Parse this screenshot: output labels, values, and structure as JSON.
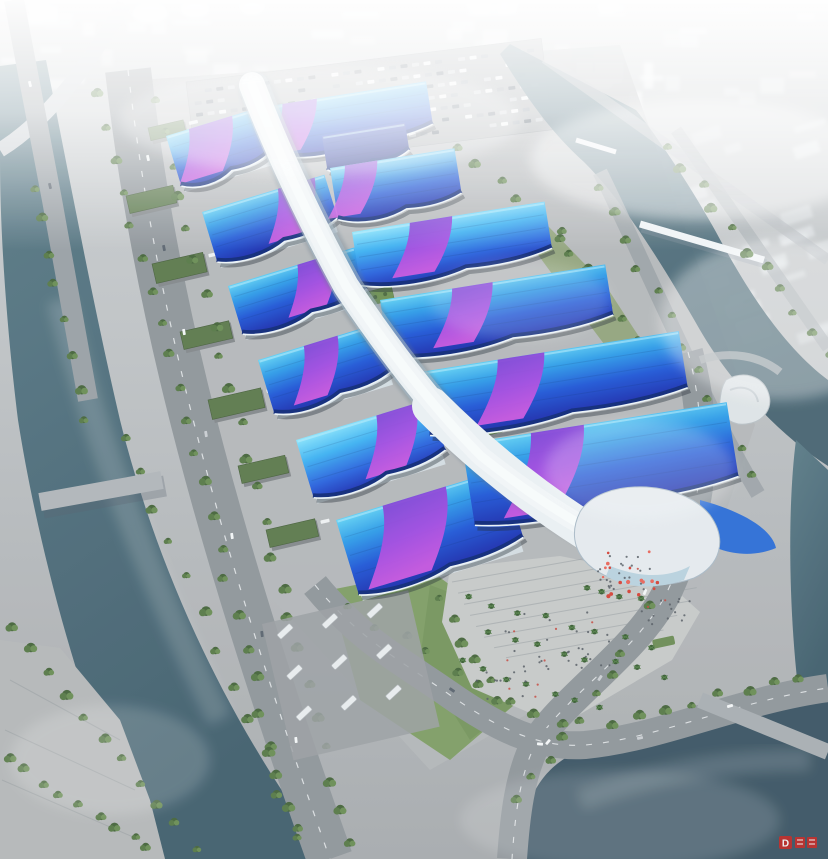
{
  "meta": {
    "aria_label": "Aerial architectural rendering of a large exhibition and convention center campus with blue and purple wave roofs, a white central concourse spine, flanked by rivers, roads and parkland under haze"
  },
  "watermark": {
    "glyph": "D",
    "color": "#c5302c"
  },
  "palette": {
    "ground_top": "#ced2d4",
    "ground_bottom": "#a7abae",
    "concrete": "#b8bbbd",
    "apron": "#b3b6b8",
    "asphalt": "#8f969b",
    "road_light": "#aab0b4",
    "water": "#52707d",
    "water_dark": "#3d5665",
    "tree": "#4a6a40",
    "lawn": "#7f9e66",
    "roof_cyan": "#63d2f4",
    "roof_blue": "#2158d6",
    "roof_deep": "#1d2fae",
    "roof_purple": "#7b3bd2",
    "roof_magenta": "#cf58e0",
    "spine_white": "#eaf0f3",
    "eave_white": "#ecf4f8",
    "shed_green": "#5d7a4e",
    "flower_red": "#d5453a",
    "haze": "#ffffff"
  },
  "venue": {
    "halls": [
      {
        "id": "a-left",
        "x": 166,
        "y": 136,
        "w": 96,
        "h": 50,
        "rot": -17,
        "tone": "std",
        "ribbon": [
          0.25,
          0.72
        ],
        "wall": true
      },
      {
        "id": "b-left",
        "x": 202,
        "y": 212,
        "w": 128,
        "h": 50,
        "rot": -17,
        "tone": "std",
        "ribbon": [
          0.62,
          0.92
        ],
        "wall": true
      },
      {
        "id": "c-left",
        "x": 228,
        "y": 286,
        "w": 132,
        "h": 48,
        "rot": -17,
        "tone": "std",
        "ribbon": [
          0.55,
          0.85
        ],
        "wall": true
      },
      {
        "id": "d-left",
        "x": 258,
        "y": 360,
        "w": 126,
        "h": 54,
        "rot": -17,
        "tone": "std",
        "ribbon": [
          0.38,
          0.66
        ],
        "wall": true
      },
      {
        "id": "e-left",
        "x": 296,
        "y": 440,
        "w": 140,
        "h": 58,
        "rot": -17,
        "tone": "bright",
        "ribbon": [
          0.6,
          0.9
        ],
        "wall": true
      },
      {
        "id": "f-left",
        "x": 336,
        "y": 520,
        "w": 174,
        "h": 76,
        "rot": -17,
        "tone": "std",
        "ribbon": [
          0.28,
          0.66
        ],
        "wall": true
      },
      {
        "id": "a-right",
        "x": 270,
        "y": 106,
        "w": 158,
        "h": 48,
        "rot": -9,
        "tone": "std",
        "ribbon": [
          0.08,
          0.3
        ]
      },
      {
        "id": "a2-right",
        "x": 322,
        "y": 136,
        "w": 84,
        "h": 32,
        "rot": -9,
        "tone": "navy"
      },
      {
        "id": "b-right",
        "x": 330,
        "y": 168,
        "w": 126,
        "h": 50,
        "rot": -9,
        "tone": "std",
        "ribbon": [
          0.12,
          0.38
        ]
      },
      {
        "id": "c-right",
        "x": 352,
        "y": 232,
        "w": 195,
        "h": 52,
        "rot": -9,
        "tone": "bright",
        "ribbon": [
          0.3,
          0.52
        ]
      },
      {
        "id": "d-right",
        "x": 380,
        "y": 300,
        "w": 228,
        "h": 56,
        "rot": -9,
        "tone": "std",
        "ribbon": [
          0.32,
          0.5
        ]
      },
      {
        "id": "e-right",
        "x": 420,
        "y": 372,
        "w": 262,
        "h": 62,
        "rot": -9,
        "tone": "std",
        "ribbon": [
          0.3,
          0.48
        ]
      },
      {
        "id": "f-right",
        "x": 462,
        "y": 444,
        "w": 268,
        "h": 80,
        "rot": -9,
        "tone": "std",
        "ribbon": [
          0.26,
          0.46
        ]
      }
    ],
    "courtyards": [
      [
        262,
        140,
        58,
        16
      ],
      [
        336,
        130,
        24,
        11
      ],
      [
        366,
        292,
        26,
        14
      ],
      [
        452,
        298,
        46,
        18
      ],
      [
        474,
        424,
        26,
        14
      ]
    ],
    "sheds": [
      [
        148,
        128,
        36,
        15
      ],
      [
        126,
        196,
        48,
        20
      ],
      [
        152,
        264,
        52,
        22
      ],
      [
        180,
        332,
        50,
        20
      ],
      [
        208,
        400,
        54,
        22
      ],
      [
        238,
        466,
        48,
        20
      ],
      [
        266,
        530,
        50,
        20
      ]
    ]
  },
  "landscape": {
    "tree_lines": [
      [
        100,
        96,
        296,
        840,
        24
      ],
      [
        154,
        100,
        350,
        845,
        24
      ],
      [
        126,
        436,
        296,
        826,
        12
      ],
      [
        34,
        186,
        84,
        420,
        8
      ],
      [
        12,
        628,
        196,
        845,
        11
      ],
      [
        700,
        428,
        646,
        608,
        7
      ],
      [
        624,
        654,
        520,
        800,
        8
      ],
      [
        352,
        610,
        560,
        726,
        9
      ],
      [
        610,
        722,
        800,
        676,
        8
      ],
      [
        598,
        186,
        752,
        474,
        12
      ],
      [
        668,
        146,
        828,
        352,
        11
      ],
      [
        556,
        236,
        652,
        356,
        8
      ],
      [
        440,
        600,
        500,
        700,
        6
      ],
      [
        8,
        760,
        150,
        850,
        9
      ],
      [
        460,
        150,
        560,
        230,
        6
      ]
    ],
    "palm_lines": [
      [
        466,
        598,
        648,
        646,
        8
      ],
      [
        486,
        634,
        664,
        676,
        8
      ],
      [
        460,
        662,
        600,
        706,
        7
      ],
      [
        588,
        586,
        640,
        600,
        4
      ]
    ]
  },
  "traffic": {
    "parking": {
      "rows": 7,
      "cols": 30
    },
    "buses": 9,
    "road_cars": [
      [
        148,
        158,
        78,
        0
      ],
      [
        164,
        248,
        79,
        1
      ],
      [
        184,
        332,
        80,
        0
      ],
      [
        206,
        434,
        81,
        2
      ],
      [
        232,
        536,
        82,
        0
      ],
      [
        262,
        634,
        83,
        1
      ],
      [
        296,
        740,
        84,
        0
      ],
      [
        678,
        420,
        96,
        0
      ],
      [
        666,
        500,
        103,
        1
      ],
      [
        645,
        592,
        112,
        0
      ],
      [
        600,
        678,
        124,
        2
      ],
      [
        548,
        742,
        130,
        0
      ],
      [
        452,
        690,
        35,
        1
      ],
      [
        540,
        744,
        5,
        0
      ],
      [
        640,
        738,
        -12,
        2
      ],
      [
        730,
        706,
        -16,
        0
      ],
      [
        30,
        84,
        76,
        0
      ],
      [
        50,
        186,
        77,
        1
      ]
    ]
  },
  "city": {
    "top_blocks": 48,
    "right_blocks": 30,
    "towers": 6,
    "left_blocks": 8,
    "domes": [
      [
        150,
        14,
        18,
        10
      ],
      [
        195,
        10,
        14,
        8
      ],
      [
        252,
        8,
        12,
        7
      ]
    ]
  },
  "people": {
    "clusters": [
      [
        598,
        556,
        52,
        34,
        24
      ],
      [
        505,
        612,
        110,
        58,
        30
      ],
      [
        640,
        598,
        50,
        28,
        16
      ],
      [
        470,
        660,
        80,
        40,
        18
      ]
    ],
    "red_decor": [
      [
        602,
        548,
        56,
        50,
        18
      ]
    ]
  }
}
